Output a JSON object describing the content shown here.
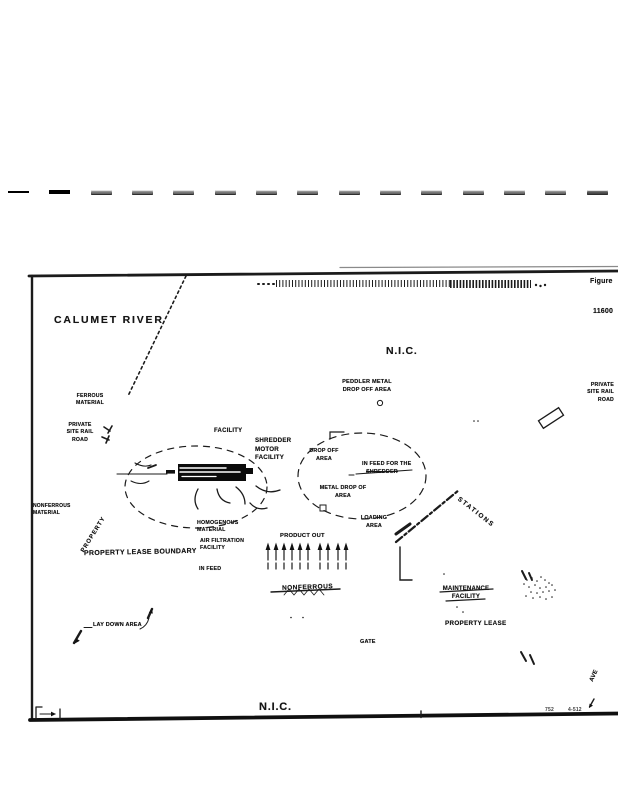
{
  "figure": {
    "label": "Figure",
    "number": "11600"
  },
  "map": {
    "calumet_river": "CALUMET RIVER",
    "nic_top": "N.I.C.",
    "nic_bottom": "N.I.C.",
    "peddler_metal": "PEDDLER METAL\nDROP OFF AREA",
    "ferrous_material": "FERROUS\nMATERIAL",
    "private_rail_left": "PRIVATE\nSITE RAIL\nROAD",
    "private_rail_right": "PRIVATE\nSITE RAIL\nROAD",
    "facility": "FACILITY",
    "shredder_motor_facility": "SHREDDER\nMOTOR\nFACILITY",
    "drop_off_area": "DROP OFF\nAREA",
    "in_feed_for_the": "IN FEED FOR THE",
    "shredder_struck": "SHREDDER",
    "metal_drop_of_area": "METAL DROP OF\nAREA",
    "loading_area": "LOADING\nAREA",
    "stations": "STATIONS",
    "nonferrous_material_left": "NONFERROUS\nMATERIAL",
    "property_rotated": "PROPERTY",
    "property_lease_boundary": "PROPERTY LEASE BOUNDARY",
    "homogenous_material": "HOMOGENOUS\nMATERIAL",
    "air_filtration_facility": "AIR FILTRATION\nFACILITY",
    "in_feed": "IN FEED",
    "product_out": "PRODUCT OUT",
    "nonferrous_struck": "NONFERROUS",
    "maintenance_facility": "MAINTENANCE\nFACILITY",
    "property_lease": "PROPERTY LEASE",
    "lay_down_area": "LAY DOWN AREA",
    "gate": "GATE",
    "ave": "AVE",
    "edge_mark_left": "752",
    "edge_mark_right": "4-512"
  }
}
